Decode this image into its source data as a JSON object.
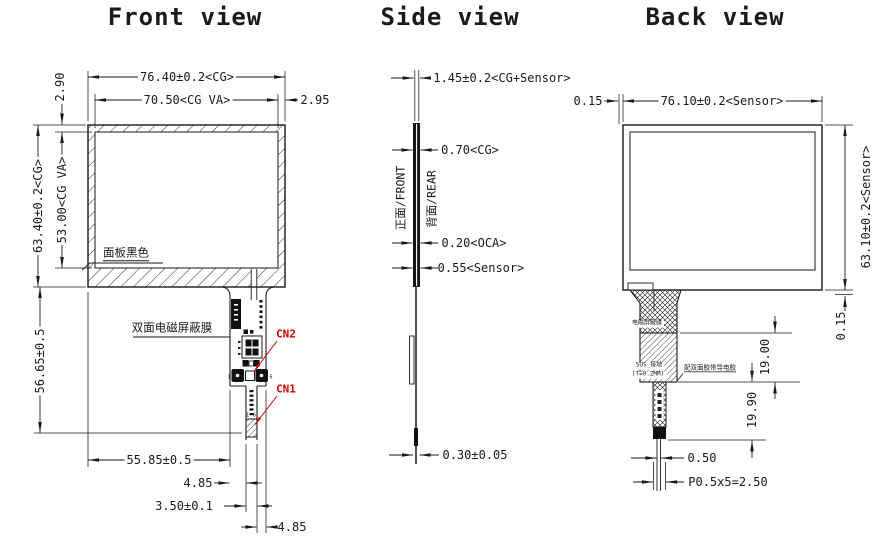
{
  "front": {
    "title": "Front view",
    "dim_width_cg": "76.40±0.2<CG>",
    "dim_width_va": "70.50<CG VA>",
    "dim_bezel_right": "2.95",
    "dim_bezel_top": "2.90",
    "dim_height_cg": "63.40±0.2<CG>",
    "dim_height_va": "53.00<CG VA>",
    "dim_tail_length": "56.65±0.5",
    "dim_tail_offset": "55.85±0.5",
    "dim_tail_margin_left": "4.85",
    "dim_fpc_width": "3.50±0.1",
    "dim_tail_margin_right": "4.85",
    "label_panel_black": "面板黑色",
    "label_shield_film": "双面电磁屏蔽膜",
    "label_cn2": "CN2",
    "label_cn1": "CN1",
    "cn2_pin1": "1",
    "cn2_pin6": "6",
    "cn1_pin1": "1",
    "cn1_pin6": "6"
  },
  "side": {
    "title": "Side view",
    "dim_total": "1.45±0.2<CG+Sensor>",
    "dim_cg": "0.70<CG>",
    "dim_oca": "0.20<OCA>",
    "dim_sensor": "0.55<Sensor>",
    "dim_fpc": "0.30±0.05",
    "label_front_face": "正面/FRONT",
    "label_rear_face": "背面/REAR"
  },
  "back": {
    "title": "Back view",
    "dim_offset_left": "0.15",
    "dim_width_sensor": "76.10±0.2<Sensor>",
    "dim_height_sensor": "63.10±0.2<Sensor>",
    "dim_offset_bottom": "0.15",
    "dim_shield_length": "19.00",
    "dim_tail_length": "19.90",
    "dim_fpc_end_width": "0.50",
    "dim_pitch": "P0.5x5=2.50",
    "label_shield_film": "电磁屏蔽膜",
    "label_sus_ground": "SUS_接地",
    "label_sus_thickness": "(T=0.2MM)",
    "label_conductive_adhesive": "配双面胶带导电胶"
  },
  "colors": {
    "line": "#1a1a1a",
    "accent_red": "#d40000",
    "background": "#ffffff"
  }
}
